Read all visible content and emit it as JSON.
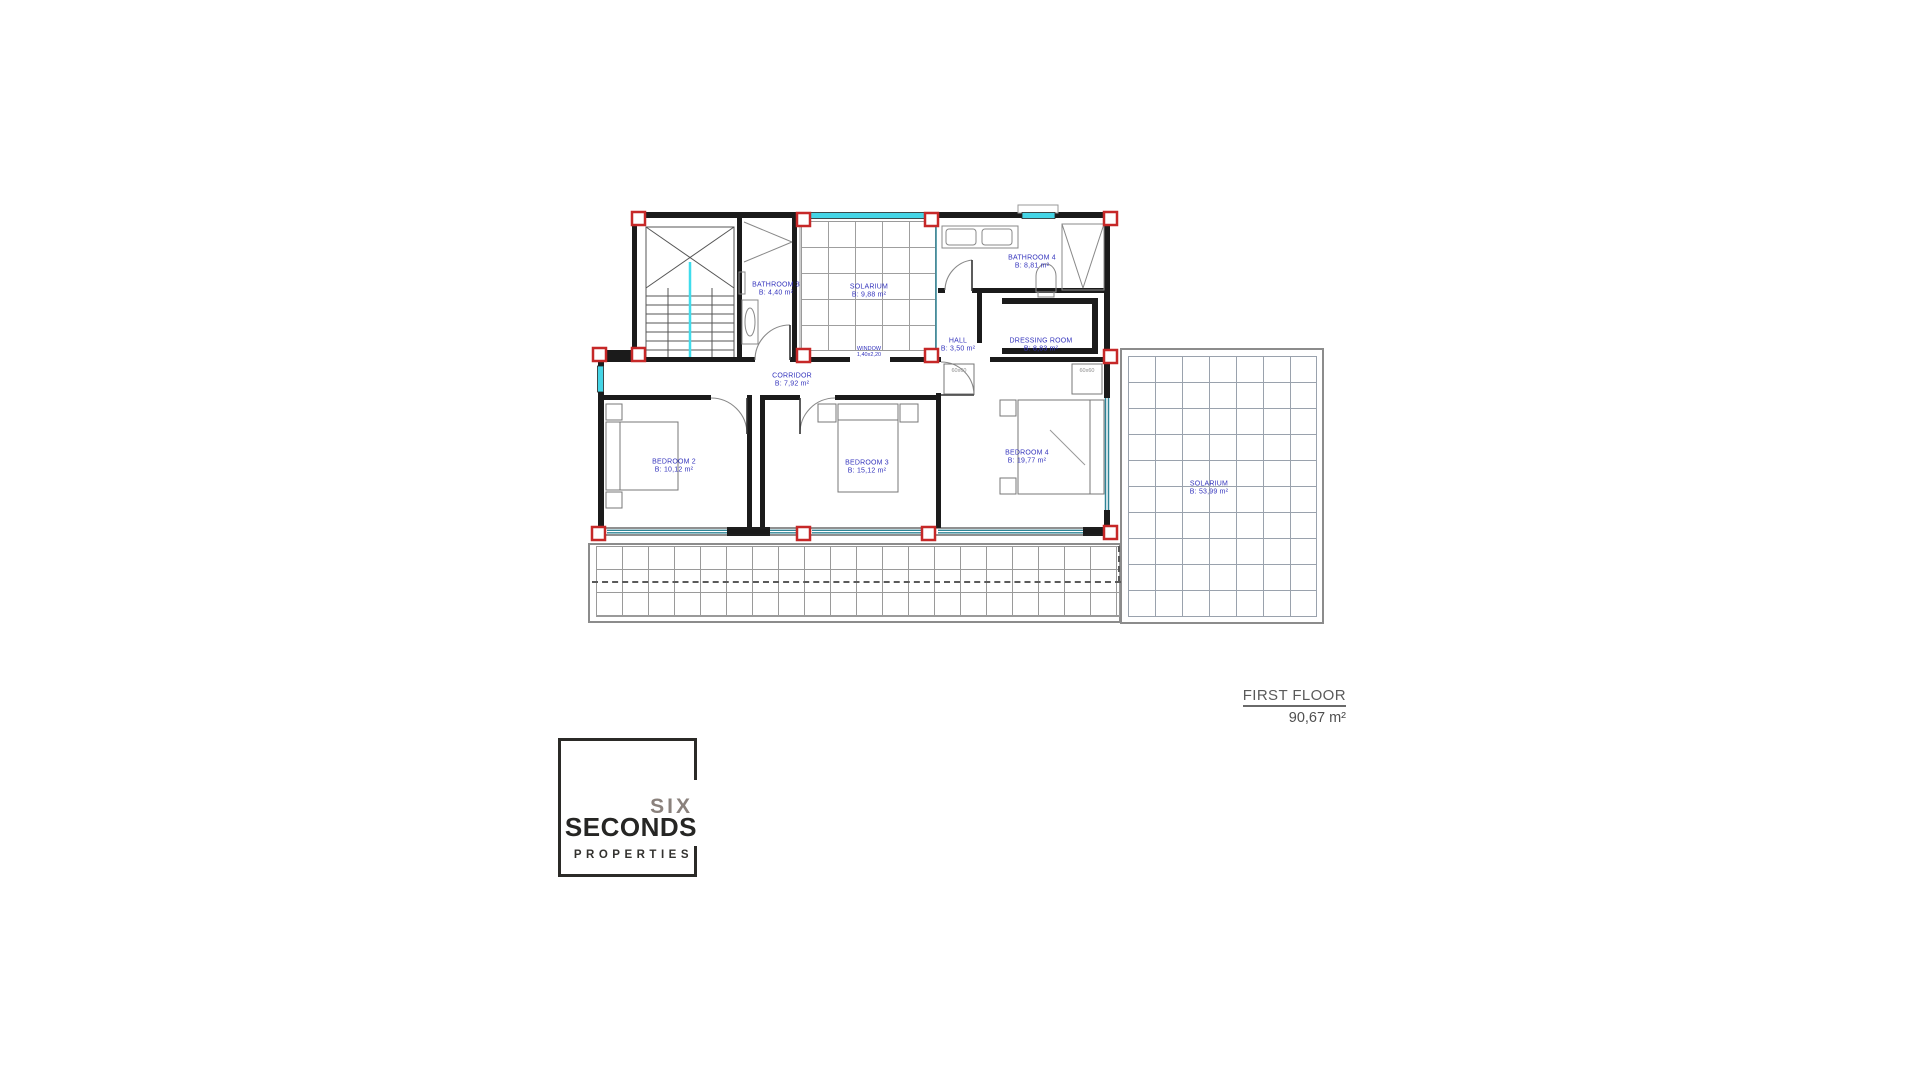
{
  "plan": {
    "rooms": [
      {
        "id": "bathroom-3",
        "label": "BATHROOM 3",
        "area": "B: 4,40 m²"
      },
      {
        "id": "solarium-top",
        "label": "SOLARIUM",
        "area": "B: 9,88 m²"
      },
      {
        "id": "bathroom-4",
        "label": "BATHROOM 4",
        "area": "B: 8,81 m²"
      },
      {
        "id": "hall",
        "label": "HALL",
        "area": "B: 3,50 m²"
      },
      {
        "id": "dressing-room",
        "label": "DRESSING ROOM",
        "area": "B: 8,83 m²"
      },
      {
        "id": "corridor",
        "label": "CORRIDOR",
        "area": "B: 7,92 m²"
      },
      {
        "id": "bedroom-2",
        "label": "BEDROOM 2",
        "area": "B: 10,12 m²"
      },
      {
        "id": "bedroom-3",
        "label": "BEDROOM 3",
        "area": "B: 15,12 m²"
      },
      {
        "id": "bedroom-4",
        "label": "BEDROOM 4",
        "area": "B: 19,77 m²"
      },
      {
        "id": "solarium-right",
        "label": "SOLARIUM",
        "area": "B: 53,99 m²"
      }
    ],
    "annotations": {
      "window_label": "WINDOW",
      "window_dim": "1,40x2,20",
      "closet_left": "60x60",
      "closet_right": "60x60"
    }
  },
  "title_block": {
    "title": "FIRST FLOOR",
    "area": "90,67 m²"
  },
  "logo": {
    "word1": "SIX",
    "word2": "SECONDS",
    "word3": "PROPERTIES"
  },
  "colors": {
    "label_blue": "#3434bd",
    "column_red": "#c62828",
    "window_cyan": "#45d5e6",
    "glazing_teal": "#2f8496",
    "wall_black": "#1b1b1b",
    "grid_gray": "#9a9a9a",
    "title_gray": "#5a5a5a",
    "logo_taupe": "#8a817c",
    "logo_black": "#262624"
  }
}
